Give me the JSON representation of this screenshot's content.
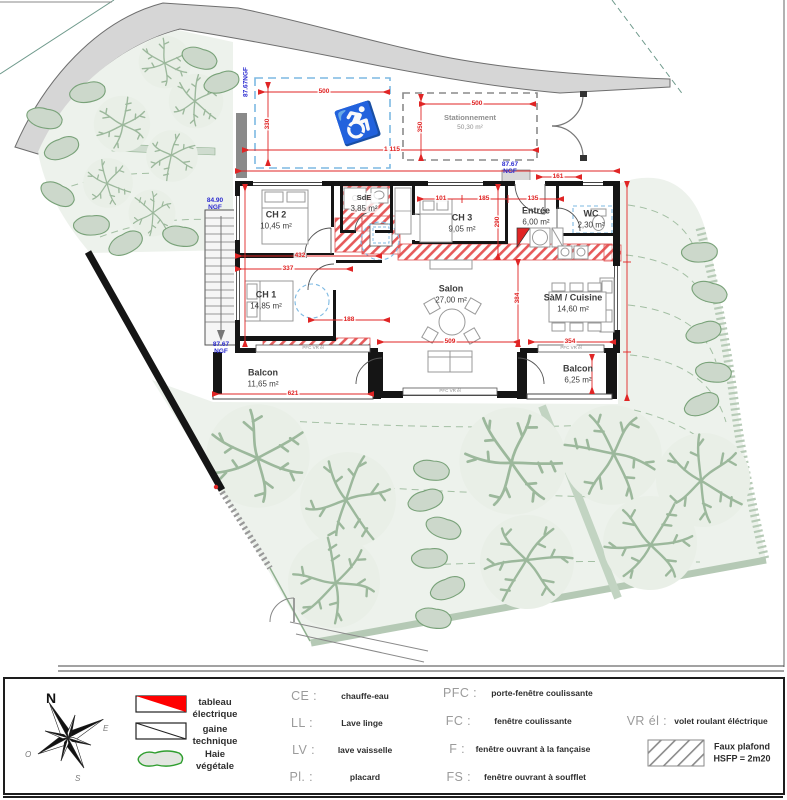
{
  "rooms": {
    "ch2": {
      "name": "CH 2",
      "area": "10,45 m²"
    },
    "sde": {
      "name": "SdE",
      "area": "3,85 m²"
    },
    "ch3": {
      "name": "CH 3",
      "area": "9,05 m²"
    },
    "entree": {
      "name": "Entrée",
      "area": "6,00 m²"
    },
    "wc": {
      "name": "WC",
      "area": "2,30 m²"
    },
    "ch1": {
      "name": "CH 1",
      "area": "14,85 m²"
    },
    "salon": {
      "name": "Salon",
      "area": "27,00 m²"
    },
    "sam": {
      "name": "SàM / Cuisine",
      "area": "14,60 m²"
    },
    "balcon1": {
      "name": "Balcon",
      "area": "11,65 m²"
    },
    "balcon2": {
      "name": "Balcon",
      "area": "6,25 m²"
    },
    "parking": {
      "name": "Stationnement",
      "area": "50,30 m²"
    }
  },
  "levels": {
    "rot": "87.67NGF",
    "l1a": "84.90",
    "l1b": "NGF",
    "l2a": "87.67",
    "l2b": "NGF",
    "l3a": "87.67",
    "l3b": "NGF"
  },
  "dims": [
    "500",
    "330",
    "1 115",
    "500",
    "350",
    "101",
    "185",
    "135",
    "161",
    "290",
    "432",
    "337",
    "188",
    "384",
    "509",
    "354",
    "621"
  ],
  "window_label": "PFC  VR él",
  "colors": {
    "dim_red": "#e02525",
    "ngf_blue": "#2b2bd0",
    "hatch_red": "#e65a5a",
    "pool_blue": "#7db9e2",
    "veg_green": "#9cb89c"
  },
  "legend": {
    "symbols": [
      {
        "l1": "tableau",
        "l2": "électrique"
      },
      {
        "l1": "gaine",
        "l2": "technique"
      },
      {
        "l1": "Haie",
        "l2": "végétale"
      }
    ],
    "abbr1": [
      {
        "k": "CE :",
        "v": "chauffe-eau"
      },
      {
        "k": "LL :",
        "v": "Lave linge"
      },
      {
        "k": "LV :",
        "v": "lave vaisselle"
      },
      {
        "k": "Pl. :",
        "v": "placard"
      }
    ],
    "abbr2": [
      {
        "k": "PFC :",
        "v": "porte-fenêtre coulissante"
      },
      {
        "k": "FC :",
        "v": "fenêtre coulissante"
      },
      {
        "k": "F :",
        "v": "fenêtre ouvrant à la fançaise"
      },
      {
        "k": "FS :",
        "v": "fenêtre ouvrant à soufflet"
      }
    ],
    "vr": {
      "k": "VR él :",
      "v": "volet roulant éléctrique"
    },
    "faux": {
      "l1": "Faux plafond",
      "l2": "HSFP = 2m20"
    },
    "compass": {
      "n": "N",
      "e": "E",
      "s": "S",
      "o": "O"
    }
  }
}
